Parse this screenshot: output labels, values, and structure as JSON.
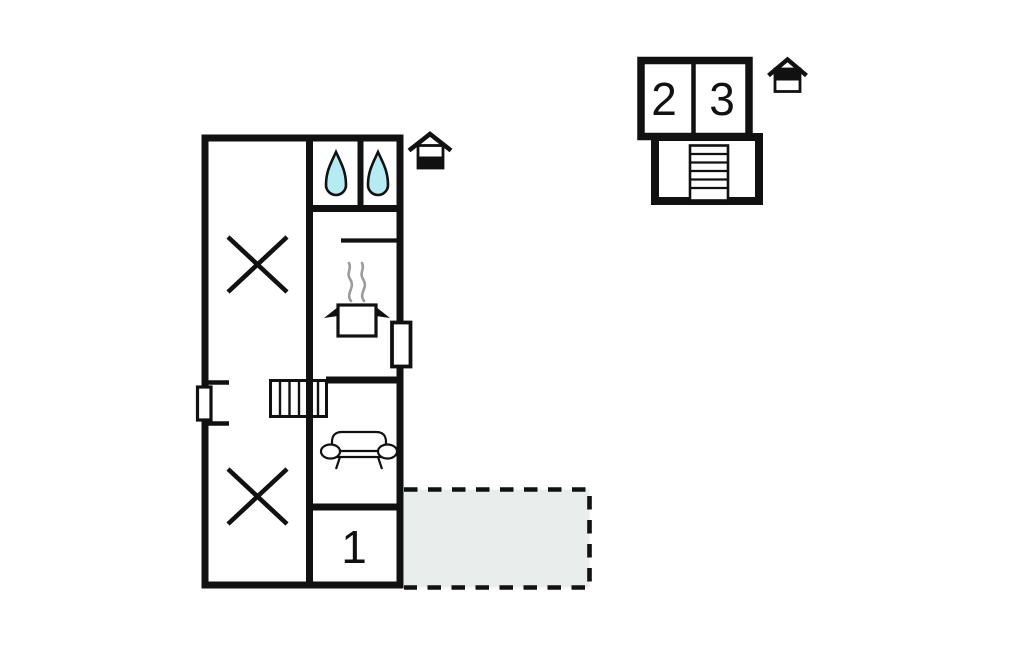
{
  "colors": {
    "wall": "#111111",
    "water": "#b6ebf3",
    "terrace": "#e9edec",
    "steam": "#9b9b9b",
    "background": "#ffffff"
  },
  "floor_plan": {
    "ground_floor": {
      "name": "ground-floor-plan",
      "rooms": [
        {
          "label": "1"
        }
      ],
      "icons": [
        "water-drop-icon",
        "water-drop-icon",
        "cooking-pot-icon",
        "sofa-icon",
        "stairs-icon",
        "window",
        "window"
      ],
      "areas": [
        "crossed-out-area",
        "crossed-out-area",
        "terrace-area"
      ]
    },
    "upper_floor": {
      "name": "upper-floor-plan",
      "rooms": [
        {
          "label": "2"
        },
        {
          "label": "3"
        }
      ],
      "icons": [
        "stairs-icon"
      ]
    },
    "level_indicators": [
      {
        "icon": "house-ground-floor-icon",
        "filled_section": "bottom"
      },
      {
        "icon": "house-upper-floor-icon",
        "filled_section": "top"
      }
    ]
  }
}
